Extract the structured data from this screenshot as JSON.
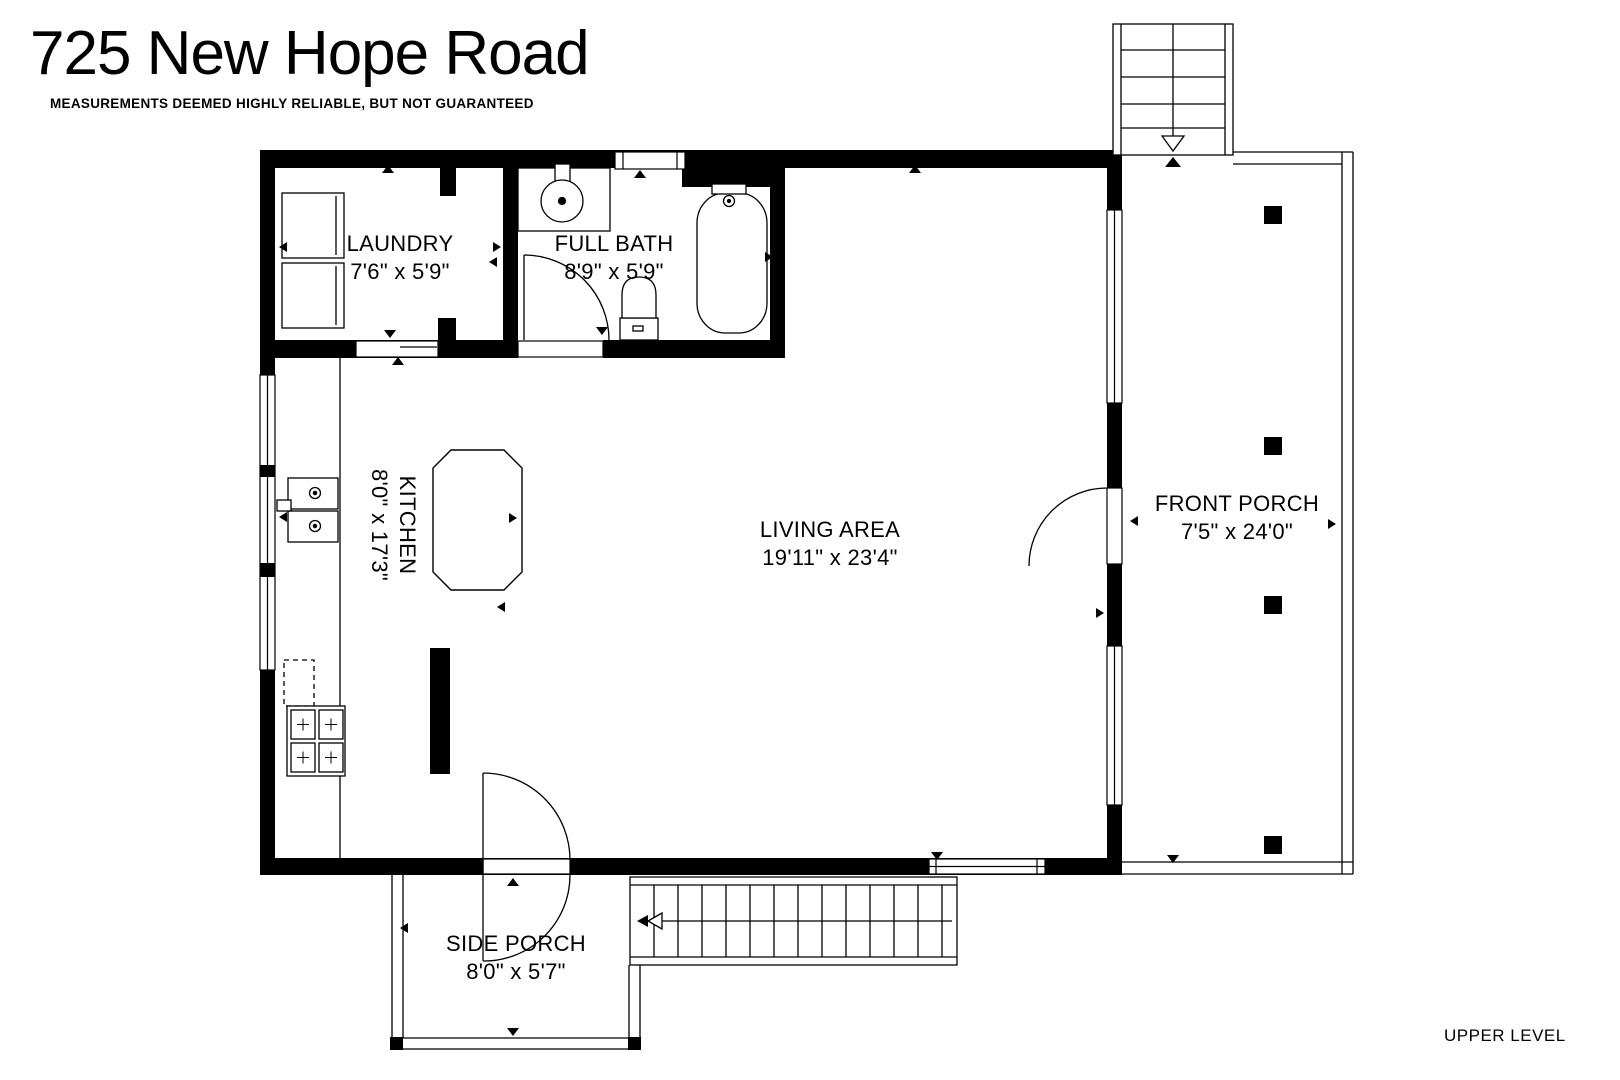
{
  "title": "725 New Hope Road",
  "disclaimer": "MEASUREMENTS DEEMED HIGHLY RELIABLE, BUT NOT GUARANTEED",
  "level_label": "UPPER LEVEL",
  "rooms": {
    "laundry": {
      "name": "LAUNDRY",
      "dims": "7'6\" x 5'9\""
    },
    "full_bath": {
      "name": "FULL BATH",
      "dims": "8'9\" x 5'9\""
    },
    "kitchen": {
      "name": "KITCHEN",
      "dims": "8'0\" x 17'3\""
    },
    "living_area": {
      "name": "LIVING AREA",
      "dims": "19'11\" x 23'4\""
    },
    "front_porch": {
      "name": "FRONT PORCH",
      "dims": "7'5\" x 24'0\""
    },
    "side_porch": {
      "name": "SIDE PORCH",
      "dims": "8'0\" x 5'7\""
    }
  },
  "colors": {
    "line": "#000000",
    "background": "#ffffff"
  }
}
